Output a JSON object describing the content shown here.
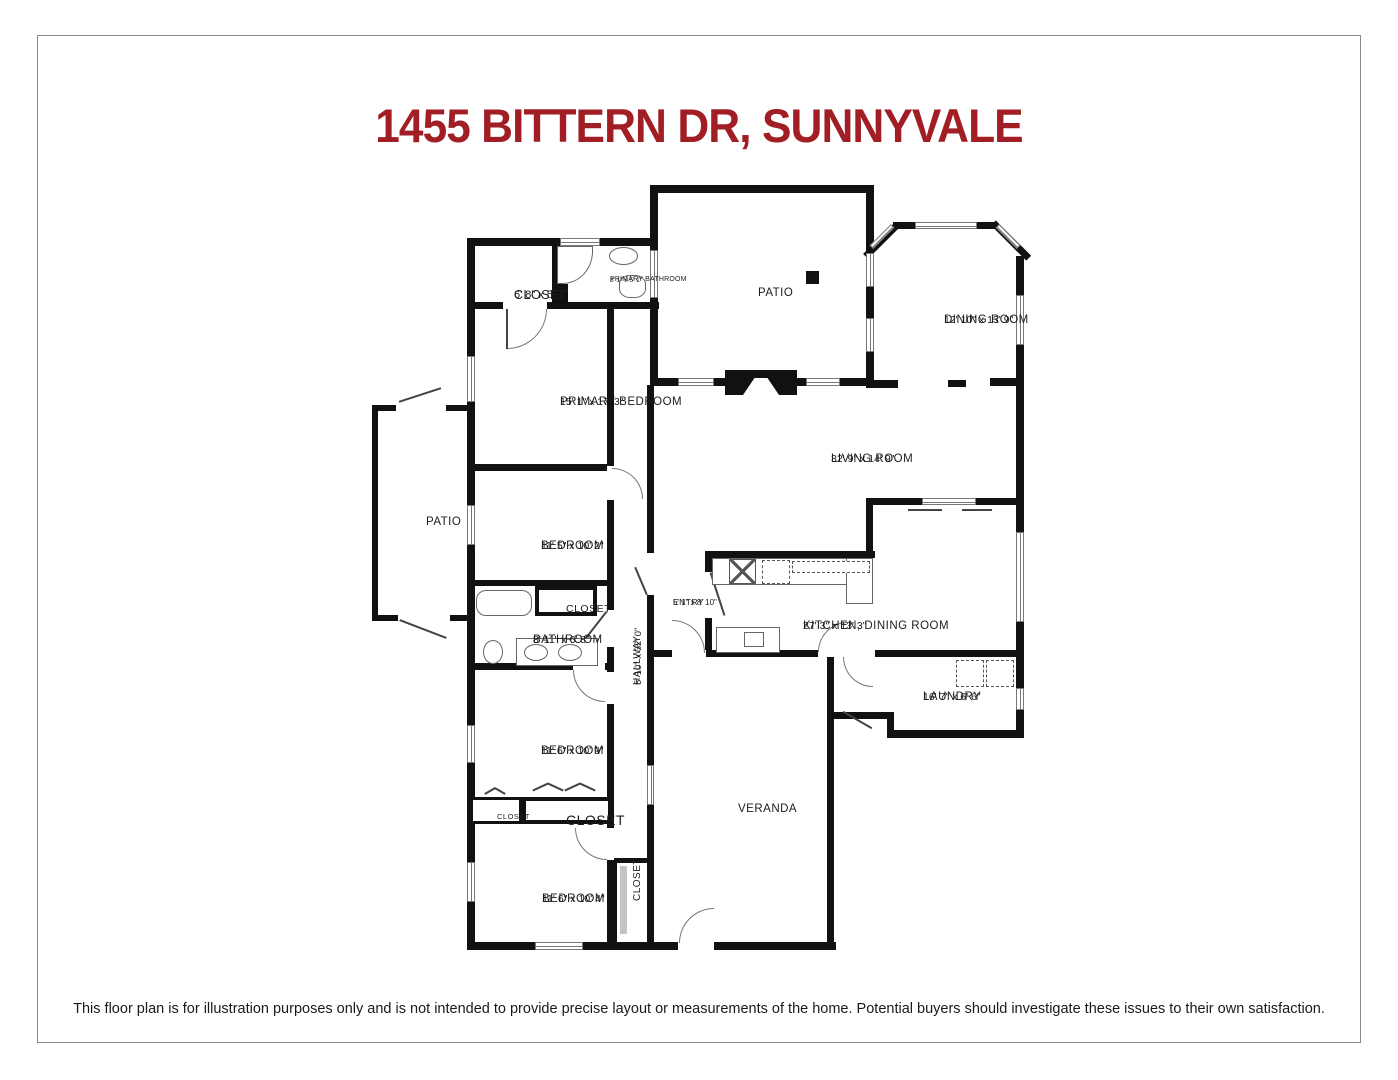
{
  "page": {
    "title": "1455 BITTERN DR, SUNNYVALE",
    "title_color": "#a01e24",
    "wall_color": "#111111",
    "disclaimer": "This floor plan is for illustration purposes only and is not intended to provide precise layout or measurements of the home. Potential buyers should investigate these issues to their own satisfaction."
  },
  "rooms": [
    {
      "name": "CLOSET",
      "dims": "6' 8\" x 5' 1\""
    },
    {
      "name": "PRIMARY BATHROOM",
      "dims": "8' 1\" x 5' 1\""
    },
    {
      "name": "PATIO",
      "dims": ""
    },
    {
      "name": "DINING ROOM",
      "dims": "12' 10\" x 13' 9\""
    },
    {
      "name": "PRIMARY BEDROOM",
      "dims": "15' 1\" x 17' 3\""
    },
    {
      "name": "LIVING ROOM",
      "dims": "32' 9\" x 14' 9\""
    },
    {
      "name": "PATIO",
      "dims": ""
    },
    {
      "name": "BEDROOM",
      "dims": "11' 5\" x 10' 2\""
    },
    {
      "name": "CLOSET",
      "dims": ""
    },
    {
      "name": "ENTRY",
      "dims": "5' 1\" x 8' 10\""
    },
    {
      "name": "KITCHEN, DINING ROOM",
      "dims": "27' 3\" x 13' 3\""
    },
    {
      "name": "BATHROOM",
      "dims": "8' 11\" x 6' 8\""
    },
    {
      "name": "HALLWAY",
      "dims": "5' 10\" x 32' 0\""
    },
    {
      "name": "LAUNDRY",
      "dims": "16' 7\" x 6' 6\""
    },
    {
      "name": "BEDROOM",
      "dims": "11' 6\" x 10' 9\""
    },
    {
      "name": "CLOSET",
      "dims": ""
    },
    {
      "name": "CLOSET",
      "dims": ""
    },
    {
      "name": "VERANDA",
      "dims": ""
    },
    {
      "name": "BEDROOM",
      "dims": "11' 6\" x 10' 4\""
    },
    {
      "name": "CLOSET",
      "dims": ""
    }
  ]
}
